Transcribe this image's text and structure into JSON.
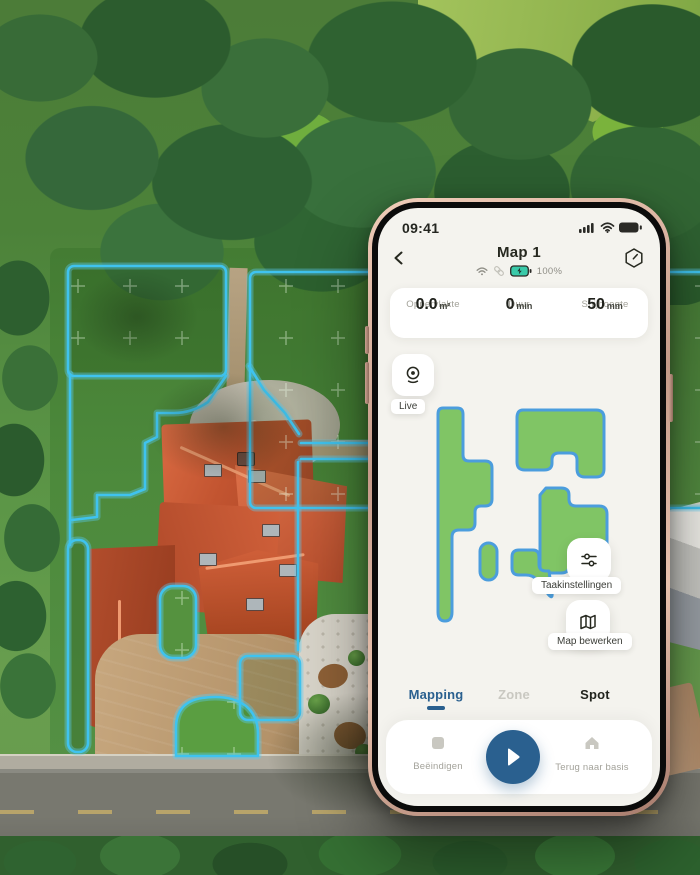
{
  "phone": {
    "status": {
      "time": "09:41"
    },
    "header": {
      "title": "Map 1",
      "battery": "100%"
    },
    "stats": {
      "area_value": "0.0",
      "area_unit": "m²",
      "area_label": "Oppervlakte",
      "duration_value": "0",
      "duration_unit": "min",
      "duration_label": "Duur",
      "height_value": "50",
      "height_unit": "mm",
      "height_label": "Snijhoogte"
    },
    "live_label": "Live",
    "map_overlay": {
      "task_settings_label": "Taakinstellingen",
      "edit_map_label": "Map bewerken"
    },
    "tabs": {
      "mapping": "Mapping",
      "zone": "Zone",
      "spot": "Spot"
    },
    "controls": {
      "stop": "Beëindigen",
      "home": "Terug naar basis"
    }
  },
  "icons": {
    "status_right": [
      "signal-bars-icon",
      "wifi-icon",
      "battery-icon"
    ],
    "header_left": "chevron-left-icon",
    "header_right": "hexagon-blade-icon",
    "connectivity": [
      "wifi-icon",
      "link-icon",
      "battery-charging-icon"
    ],
    "live": "webcam-icon",
    "task_settings": "sliders-icon",
    "edit_map": "folded-map-icon",
    "stop": "square-stop-icon",
    "play": "play-icon",
    "home": "house-icon"
  },
  "colors": {
    "accent_blue": "#2a608f",
    "zone_green": "#80c565",
    "zone_stroke": "#4b9ddd",
    "outline_cyan": "#3fc3ef",
    "battery_teal": "#3acaa9",
    "screen_bg": "#f4f3ee"
  }
}
